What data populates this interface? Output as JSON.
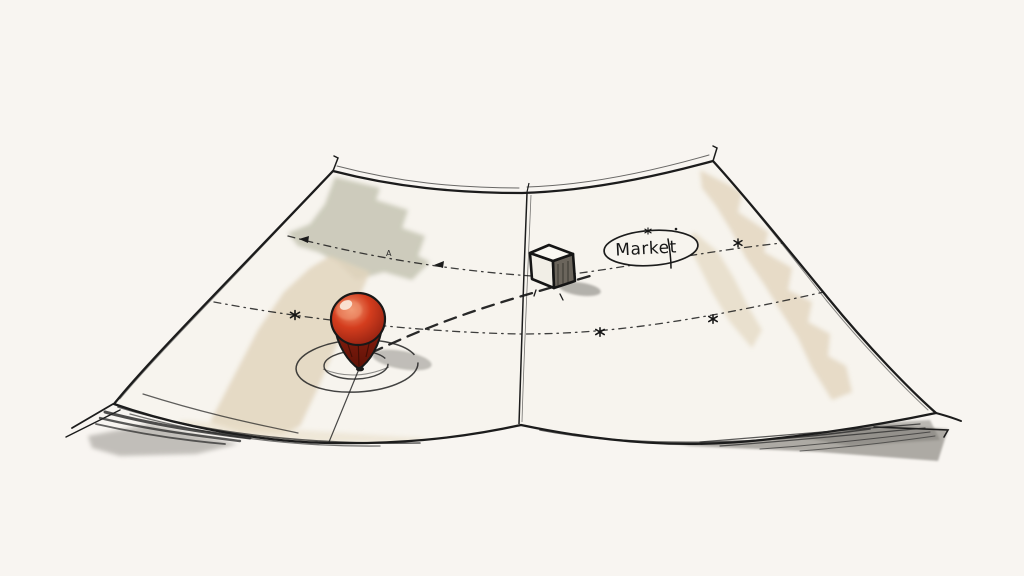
{
  "illustration": {
    "market_label": "Market",
    "waypoint_label": "A",
    "colors": {
      "background": "#f8f5f1",
      "paper": "#f7f4ee",
      "ink": "#1c1c1c",
      "patch_sage": "#c8c6b6",
      "patch_tan": "#e2d5bd",
      "patch_tan_light": "#eadfca",
      "pin_red": "#d43d1e",
      "pin_red_dark": "#8e1f10",
      "pin_cone_deep": "#5f1206",
      "pin_highlight": "#f29a74",
      "pin_spot": "#fbeadd",
      "cube_face_top": "#faf8f2",
      "cube_face_light": "#f1eee6",
      "cube_face_side": "#6b655c",
      "shadow_gray": "#a5a29c",
      "shadow_dark": "#7d7a75"
    }
  }
}
